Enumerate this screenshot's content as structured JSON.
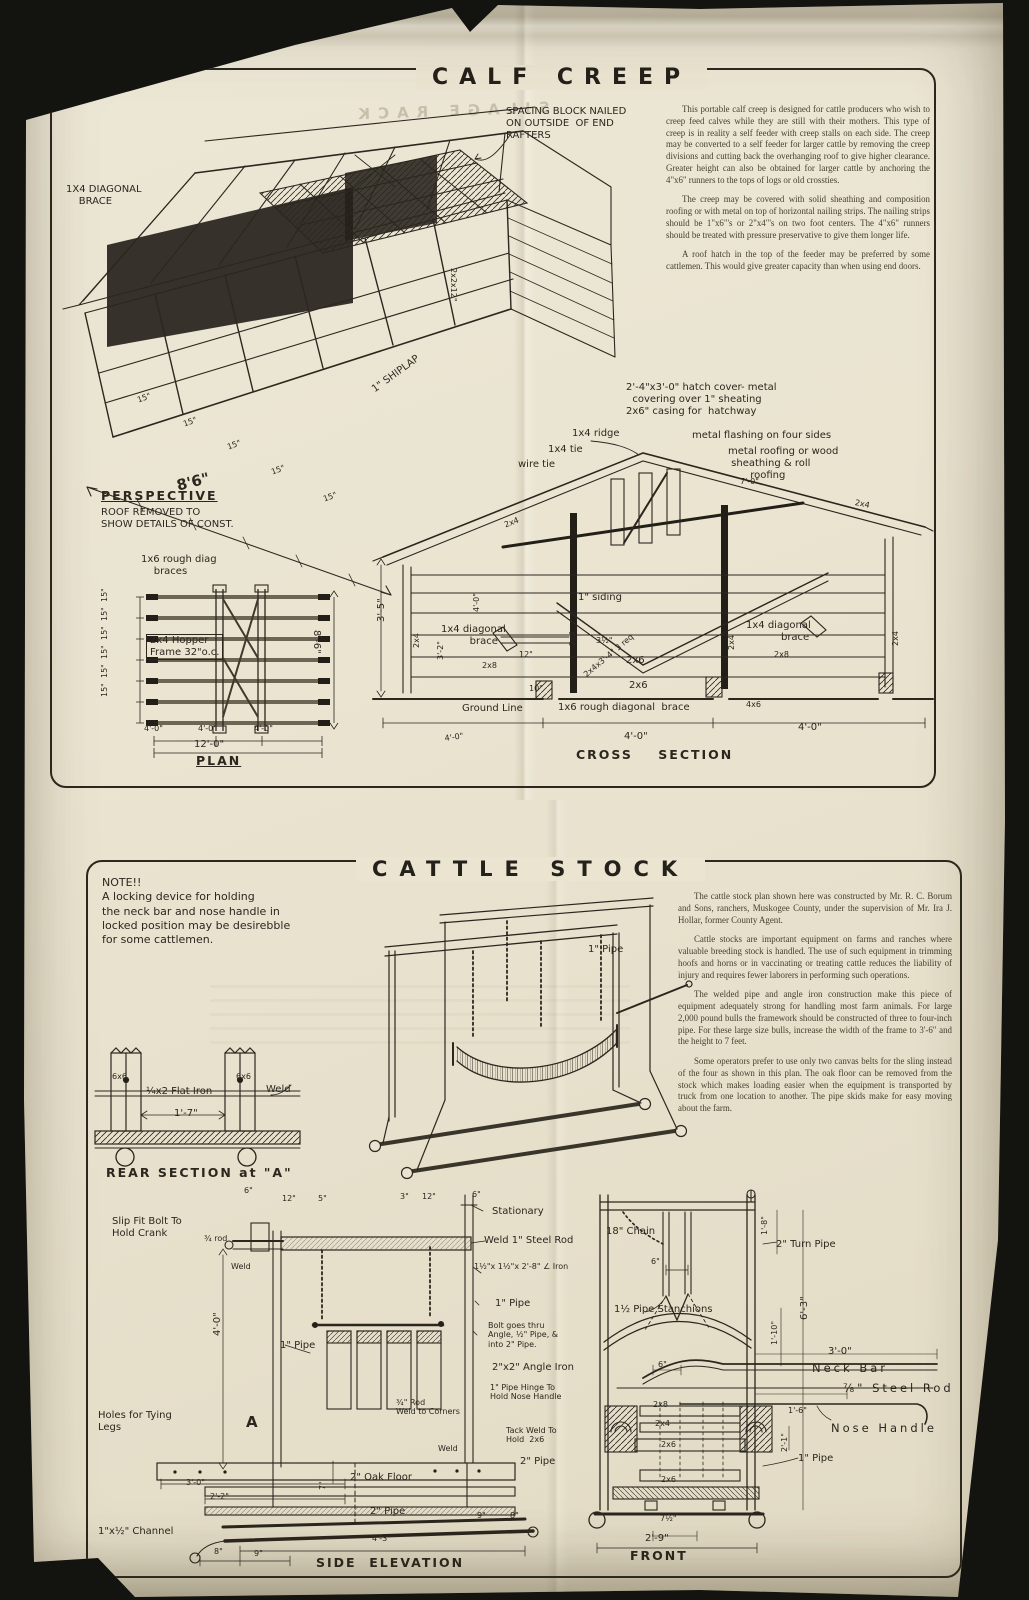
{
  "page": {
    "paper_color": "#eae4d1",
    "ink_color": "#2b271f",
    "dark_fill": "#221e18",
    "background_color": "#131310",
    "ghost_text": "SILAGE RACK"
  },
  "calf_creep": {
    "title": "CALF CREEP",
    "paragraphs": [
      "This portable calf creep is designed for cattle producers who wish to creep feed calves while they are still with their mothers. This type of creep is in reality a self feeder with creep stalls on each side. The creep may be converted to a self feeder for larger cattle by removing the creep divisions and cutting back the overhanging roof to give higher clearance. Greater height can also be obtained for larger cattle by anchoring the 4\"x6\" runners to the tops of logs or old crossties.",
      "The creep may be covered with solid sheathing and composition roofing or with metal on top of horizontal nailing strips. The nailing strips should be 1\"x6\"'s or 2\"x4\"'s on two foot centers. The 4\"x6\" runners should be treated with pressure preservative to give them longer life.",
      "A roof hatch in the top of the feeder may be preferred by some cattlemen. This would give greater capacity than when using end doors."
    ],
    "annotations": [
      {
        "n": "spacing-block-note",
        "t": "SPACING BLOCK NAILED\nON OUTSIDE  OF END\nRAFTERS",
        "x": 506,
        "y": 106
      },
      {
        "n": "diagonal-brace-label",
        "t": "1X4 DIAGONAL\n    BRACE",
        "x": 66,
        "y": 184
      },
      {
        "n": "shiplap-label",
        "t": "1\" SHIPLAP",
        "x": 370,
        "y": 386,
        "r": -36
      },
      {
        "n": "end-rafter-block-label",
        "t": "2x2x12\"",
        "x": 458,
        "y": 268,
        "r": 90,
        "c": "sm"
      },
      {
        "n": "front-spacing-tick-1",
        "t": "15\"",
        "x": 136,
        "y": 396,
        "r": -20,
        "c": "sm"
      },
      {
        "n": "front-spacing-tick-2",
        "t": "15\"",
        "x": 182,
        "y": 420,
        "r": -20,
        "c": "sm"
      },
      {
        "n": "front-spacing-tick-3",
        "t": "15\"",
        "x": 226,
        "y": 443,
        "r": -20,
        "c": "sm"
      },
      {
        "n": "front-spacing-tick-4",
        "t": "15\"",
        "x": 270,
        "y": 468,
        "r": -20,
        "c": "sm"
      },
      {
        "n": "front-spacing-tick-5",
        "t": "15\"",
        "x": 322,
        "y": 495,
        "r": -20,
        "c": "sm"
      },
      {
        "n": "overall-length-dim",
        "t": "8'6\"",
        "x": 175,
        "y": 478,
        "r": -14,
        "c": "big"
      },
      {
        "n": "perspective-caption",
        "t": "PERSPECTIVE",
        "x": 101,
        "y": 489,
        "c": "cap u"
      },
      {
        "n": "perspective-subcaption",
        "t": "ROOF REMOVED TO\nSHOW DETAILS OF CONST.",
        "x": 101,
        "y": 507
      },
      {
        "n": "plan-braces-label",
        "t": "1x6 rough diag\n    braces",
        "x": 141,
        "y": 554
      },
      {
        "n": "hopper-frame-label",
        "t": "2x4 Hopper\nFrame 32\"o.c.",
        "x": 146,
        "y": 634,
        "c": "box"
      },
      {
        "n": "plan-spacing-dim-1",
        "t": "15\"",
        "x": 100,
        "y": 602,
        "r": -90,
        "c": "sm"
      },
      {
        "n": "plan-spacing-dim-2",
        "t": "15\"",
        "x": 100,
        "y": 621,
        "r": -90,
        "c": "sm"
      },
      {
        "n": "plan-spacing-dim-3",
        "t": "15\"",
        "x": 100,
        "y": 640,
        "r": -90,
        "c": "sm"
      },
      {
        "n": "plan-spacing-dim-4",
        "t": "15\"",
        "x": 100,
        "y": 659,
        "r": -90,
        "c": "sm"
      },
      {
        "n": "plan-spacing-dim-5",
        "t": "15\"",
        "x": 100,
        "y": 678,
        "r": -90,
        "c": "sm"
      },
      {
        "n": "plan-spacing-dim-6",
        "t": "15\"",
        "x": 100,
        "y": 697,
        "r": -90,
        "c": "sm"
      },
      {
        "n": "plan-width-dim",
        "t": "8'-6\"",
        "x": 322,
        "y": 630,
        "r": 90
      },
      {
        "n": "plan-bay-dim-1",
        "t": "4'-0\"",
        "x": 144,
        "y": 724,
        "c": "sm"
      },
      {
        "n": "plan-bay-dim-2",
        "t": "4'-0\"",
        "x": 198,
        "y": 724,
        "c": "sm"
      },
      {
        "n": "plan-bay-dim-3",
        "t": "4'-0\"",
        "x": 254,
        "y": 724,
        "c": "sm"
      },
      {
        "n": "plan-total-dim",
        "t": "12'-0\"",
        "x": 194,
        "y": 739
      },
      {
        "n": "plan-caption",
        "t": "PLAN",
        "x": 196,
        "y": 754,
        "c": "cap u"
      },
      {
        "n": "hatch-cover-note",
        "t": "2'-4\"x3'-0\" hatch cover- metal\n  covering over 1\" sheating\n2x6\" casing for  hatchway",
        "x": 626,
        "y": 382
      },
      {
        "n": "ridge-label",
        "t": "1x4 ridge",
        "x": 572,
        "y": 428
      },
      {
        "n": "tie-label",
        "t": "1x4 tie",
        "x": 548,
        "y": 444
      },
      {
        "n": "wire-tie-label",
        "t": "wire tie",
        "x": 518,
        "y": 459
      },
      {
        "n": "flashing-note",
        "t": "metal flashing on four sides",
        "x": 692,
        "y": 430
      },
      {
        "n": "roofing-note",
        "t": "metal roofing or wood\n sheathing & roll\n       roofing",
        "x": 728,
        "y": 446
      },
      {
        "n": "roof-pitch-dim",
        "t": "7'-0\"",
        "x": 740,
        "y": 477,
        "c": "sm"
      },
      {
        "n": "cs-rafter-label-left",
        "t": "2x4",
        "x": 503,
        "y": 521,
        "r": -21,
        "c": "sm"
      },
      {
        "n": "cs-rafter-label-right",
        "t": "2x4",
        "x": 856,
        "y": 498,
        "r": 12,
        "c": "sm"
      },
      {
        "n": "cs-height-dim",
        "t": "3'-5\"",
        "x": 376,
        "y": 622,
        "r": -90
      },
      {
        "n": "cs-post-label-left",
        "t": "2x4",
        "x": 412,
        "y": 648,
        "r": -90,
        "c": "sm"
      },
      {
        "n": "cs-dim-4ft-vert",
        "t": "4'-0\"",
        "x": 472,
        "y": 612,
        "r": -90,
        "c": "sm"
      },
      {
        "n": "cs-dim-3-2",
        "t": "3'-2\"",
        "x": 436,
        "y": 660,
        "r": -90,
        "c": "sm"
      },
      {
        "n": "cs-diagonal-brace-left",
        "t": "1x4 diagonal\n         brace",
        "x": 441,
        "y": 624
      },
      {
        "n": "cs-dim-12",
        "t": "12\"",
        "x": 519,
        "y": 650,
        "c": "sm"
      },
      {
        "n": "cs-2x8-left",
        "t": "2x8",
        "x": 482,
        "y": 661,
        "c": "sm"
      },
      {
        "n": "cs-dim-10",
        "t": "10\"",
        "x": 529,
        "y": 684,
        "c": "sm"
      },
      {
        "n": "siding-label",
        "t": "1\" siding",
        "x": 578,
        "y": 592
      },
      {
        "n": "cs-dim-3half",
        "t": "3½\"",
        "x": 596,
        "y": 636,
        "c": "sm"
      },
      {
        "n": "hopper-board-label",
        "t": "2x4x3'-4\" 3 req",
        "x": 582,
        "y": 672,
        "r": -40,
        "c": "sm"
      },
      {
        "n": "cs-2x6-upper",
        "t": "2x6",
        "x": 626,
        "y": 655
      },
      {
        "n": "cs-2x6-lower",
        "t": "2x6",
        "x": 629,
        "y": 680
      },
      {
        "n": "cs-center-post-label",
        "t": "2x4",
        "x": 568,
        "y": 646,
        "r": -90,
        "c": "sm"
      },
      {
        "n": "cs-diagonal-brace-right",
        "t": "1x4 diagonal\n           brace",
        "x": 746,
        "y": 620
      },
      {
        "n": "cs-2x8-right",
        "t": "2x8",
        "x": 774,
        "y": 650,
        "c": "sm"
      },
      {
        "n": "cs-post-label-right",
        "t": "2x4",
        "x": 727,
        "y": 650,
        "r": -90,
        "c": "sm"
      },
      {
        "n": "cs-post-label-far-right",
        "t": "2x4",
        "x": 891,
        "y": 646,
        "r": -90,
        "c": "sm"
      },
      {
        "n": "ground-line-label",
        "t": "Ground Line",
        "x": 462,
        "y": 703
      },
      {
        "n": "cs-bottom-brace-label",
        "t": "1x6 rough diagonal  brace",
        "x": 558,
        "y": 702
      },
      {
        "n": "cs-4x6-label",
        "t": "4x6",
        "x": 746,
        "y": 700,
        "c": "sm"
      },
      {
        "n": "cs-dim-left",
        "t": "4'-0\"",
        "x": 444,
        "y": 734,
        "r": -8,
        "c": "sm"
      },
      {
        "n": "cs-dim-mid",
        "t": "4'-0\"",
        "x": 624,
        "y": 731
      },
      {
        "n": "cs-dim-right",
        "t": "4'-0\"",
        "x": 798,
        "y": 722
      },
      {
        "n": "cross-section-caption",
        "t": "CROSS    SECTION",
        "x": 576,
        "y": 748,
        "c": "cap"
      }
    ]
  },
  "cattle_stock": {
    "title": "CATTLE STOCK",
    "note": "NOTE!!\n A locking device for holding\nthe neck bar and nose handle in\nlocked position may be desirebble\nfor some cattlemen.",
    "paragraphs": [
      "The cattle stock plan shown here was constructed by Mr. R. C. Borum and Sons, ranchers, Muskogee County, under the supervision of Mr. Ira J. Hollar, former County Agent.",
      "Cattle stocks are important equipment on farms and ranches where valuable breeding stock is handled. The use of such equipment in trimming hoofs and horns or in vaccinating or treating cattle reduces the liability of injury and requires fewer laborers in performing such operations.",
      "The welded pipe and angle iron construction make this piece of equipment adequately strong for handling most farm animals. For large 2,000 pound bulls the framework should be constructed of three to four-inch pipe. For these large size bulls, increase the width of the frame to 3'-6\" and the height to 7 feet.",
      "Some operators prefer to use only two canvas belts for the sling instead of the four as shown in this plan. The oak floor can be removed from the stock which makes loading easier when the equipment is transported by truck from one location to another. The pipe skids make for easy moving about the farm."
    ],
    "annotations": [
      {
        "n": "pipe-label-perspective",
        "t": "1\" Pipe",
        "x": 588,
        "y": 944
      },
      {
        "n": "rear-post-label-left",
        "t": "6x6",
        "x": 112,
        "y": 1072,
        "c": "sm"
      },
      {
        "n": "rear-post-label-right",
        "t": "6x6",
        "x": 236,
        "y": 1072,
        "c": "sm"
      },
      {
        "n": "flat-iron-label",
        "t": "¼x2 Flat Iron",
        "x": 146,
        "y": 1086
      },
      {
        "n": "rear-weld-label",
        "t": "Weld",
        "x": 266,
        "y": 1084
      },
      {
        "n": "rear-width-dim",
        "t": "1'-7\"",
        "x": 174,
        "y": 1108
      },
      {
        "n": "rear-section-caption",
        "t": "REAR SECTION at \"A\"",
        "x": 106,
        "y": 1166,
        "c": "cap"
      },
      {
        "n": "crank-note",
        "t": "Slip Fit Bolt To\nHold Crank",
        "x": 112,
        "y": 1216
      },
      {
        "n": "rod-label",
        "t": "¾ rod",
        "x": 204,
        "y": 1234,
        "c": "sm"
      },
      {
        "n": "se-weld-label",
        "t": "Weld",
        "x": 231,
        "y": 1262,
        "c": "sm"
      },
      {
        "n": "se-dim-6",
        "t": "6\"",
        "x": 244,
        "y": 1186,
        "c": "sm"
      },
      {
        "n": "se-dim-12",
        "t": "12\"",
        "x": 282,
        "y": 1194,
        "c": "sm"
      },
      {
        "n": "se-dim-5",
        "t": "5\"",
        "x": 318,
        "y": 1194,
        "c": "sm"
      },
      {
        "n": "se-dim-3",
        "t": "3\"",
        "x": 400,
        "y": 1192,
        "c": "sm"
      },
      {
        "n": "se-dim-12b",
        "t": "12\"",
        "x": 422,
        "y": 1192,
        "c": "sm"
      },
      {
        "n": "se-dim-6b",
        "t": "6\"",
        "x": 472,
        "y": 1190,
        "c": "sm"
      },
      {
        "n": "stationary-label",
        "t": "Stationary",
        "x": 492,
        "y": 1206
      },
      {
        "n": "steel-rod-weld-note",
        "t": "Weld 1\" Steel Rod",
        "x": 484,
        "y": 1235
      },
      {
        "n": "angle-iron-size-note",
        "t": "1½\"x 1½\"x 2'-8\" ∠ Iron",
        "x": 474,
        "y": 1262,
        "c": "sm"
      },
      {
        "n": "se-pipe-label",
        "t": "1\" Pipe",
        "x": 495,
        "y": 1298
      },
      {
        "n": "bolt-note",
        "t": "Bolt goes thru\nAngle, ½\" Pipe, &\ninto 2\" Pipe.",
        "x": 488,
        "y": 1321,
        "c": "sm"
      },
      {
        "n": "angle-iron-label",
        "t": "2\"x2\" Angle Iron",
        "x": 492,
        "y": 1362
      },
      {
        "n": "pipe-hinge-note",
        "t": "1\" Pipe Hinge To\nHold Nose Handle",
        "x": 490,
        "y": 1383,
        "c": "sm"
      },
      {
        "n": "tack-weld-note",
        "t": "Tack Weld To\nHold  2x6",
        "x": 506,
        "y": 1426,
        "c": "sm"
      },
      {
        "n": "se-2in-pipe-label",
        "t": "2\" Pipe",
        "x": 520,
        "y": 1456
      },
      {
        "n": "se-weld2-label",
        "t": "Weld",
        "x": 438,
        "y": 1444,
        "c": "sm"
      },
      {
        "n": "rod-corners-note",
        "t": "¾\" Rod\nWeld to Corners",
        "x": 396,
        "y": 1398,
        "c": "sm"
      },
      {
        "n": "se-sling-pipe-label",
        "t": "1\" Pipe",
        "x": 280,
        "y": 1340
      },
      {
        "n": "se-height-dim",
        "t": "4'-0\"",
        "x": 212,
        "y": 1336,
        "r": -90
      },
      {
        "n": "tying-holes-note",
        "t": "Holes for Tying\nLegs",
        "x": 98,
        "y": 1410
      },
      {
        "n": "section-a-marker",
        "t": "A",
        "x": 246,
        "y": 1414,
        "c": "big"
      },
      {
        "n": "se-dim-3ft",
        "t": "3'-0\"",
        "x": 186,
        "y": 1478,
        "c": "sm"
      },
      {
        "n": "se-dim-2-2",
        "t": "2'-2\"",
        "x": 210,
        "y": 1492,
        "c": "sm"
      },
      {
        "n": "channel-label",
        "t": "1\"x½\" Channel",
        "x": 98,
        "y": 1526
      },
      {
        "n": "se-dim-8",
        "t": "8\"",
        "x": 214,
        "y": 1547,
        "c": "sm"
      },
      {
        "n": "se-dim-9",
        "t": "9\"",
        "x": 254,
        "y": 1549,
        "c": "sm"
      },
      {
        "n": "oak-floor-label",
        "t": "2\" Oak Floor",
        "x": 350,
        "y": 1472
      },
      {
        "n": "se-bottom-pipe-label",
        "t": "2\" Pipe",
        "x": 370,
        "y": 1506
      },
      {
        "n": "se-dim-4-3",
        "t": "4'-3\"",
        "x": 372,
        "y": 1534,
        "c": "sm"
      },
      {
        "n": "se-dim-7",
        "t": "7\"",
        "x": 318,
        "y": 1490,
        "r": -90,
        "c": "sm"
      },
      {
        "n": "side-elevation-caption",
        "t": "SIDE  ELEVATION",
        "x": 316,
        "y": 1556,
        "c": "cap"
      },
      {
        "n": "mid-dim-9",
        "t": "9\"",
        "x": 477,
        "y": 1511,
        "c": "sm"
      },
      {
        "n": "mid-dim-8",
        "t": "8\"",
        "x": 510,
        "y": 1511,
        "c": "sm"
      },
      {
        "n": "chain-label",
        "t": "18\" Chain",
        "x": 606,
        "y": 1226
      },
      {
        "n": "fr-dim-6",
        "t": "6\"",
        "x": 651,
        "y": 1257,
        "c": "sm"
      },
      {
        "n": "turn-pipe-label",
        "t": "2\" Turn Pipe",
        "x": 776,
        "y": 1239
      },
      {
        "n": "fr-dim-1-8",
        "t": "1'-8\"",
        "x": 760,
        "y": 1235,
        "r": -90,
        "c": "sm"
      },
      {
        "n": "fr-dim-6-3",
        "t": "6'-3\"",
        "x": 799,
        "y": 1320,
        "r": -90
      },
      {
        "n": "fr-dim-1-10",
        "t": "1'-10\"",
        "x": 770,
        "y": 1345,
        "r": -90,
        "c": "sm"
      },
      {
        "n": "stanchion-label",
        "t": "1½ Pipe Stanchions",
        "x": 614,
        "y": 1304
      },
      {
        "n": "fr-dim-6b",
        "t": "6\"",
        "x": 658,
        "y": 1360,
        "c": "sm"
      },
      {
        "n": "fr-2x8-label",
        "t": "2x8",
        "x": 653,
        "y": 1400,
        "c": "sm"
      },
      {
        "n": "fr-2x4-label",
        "t": "2x4",
        "x": 655,
        "y": 1419,
        "c": "sm"
      },
      {
        "n": "fr-2x6-label",
        "t": "2x6",
        "x": 661,
        "y": 1440,
        "c": "sm"
      },
      {
        "n": "fr-2x6b-label",
        "t": "2x6",
        "x": 661,
        "y": 1475,
        "c": "sm"
      },
      {
        "n": "fr-dim-7half",
        "t": "7½\"",
        "x": 660,
        "y": 1514,
        "c": "sm"
      },
      {
        "n": "fr-dim-2-9",
        "t": "2'-9\"",
        "x": 645,
        "y": 1533
      },
      {
        "n": "front-caption",
        "t": "FRONT",
        "x": 630,
        "y": 1549,
        "c": "cap"
      },
      {
        "n": "neck-bar-dim",
        "t": "3'-0\"",
        "x": 828,
        "y": 1346
      },
      {
        "n": "neck-bar-label",
        "t": "Neck Bar",
        "x": 812,
        "y": 1362,
        "c": "sp"
      },
      {
        "n": "steel-rod-label",
        "t": "⅞\" Steel Rod",
        "x": 843,
        "y": 1382,
        "c": "sp"
      },
      {
        "n": "fr-dim-1-6",
        "t": "1'-6\"",
        "x": 788,
        "y": 1406,
        "c": "sm"
      },
      {
        "n": "nose-handle-label",
        "t": "Nose Handle",
        "x": 831,
        "y": 1422,
        "c": "sp"
      },
      {
        "n": "fr-pipe-label",
        "t": "1\" Pipe",
        "x": 798,
        "y": 1453
      },
      {
        "n": "fr-dim-2-1",
        "t": "2'-1\"",
        "x": 780,
        "y": 1452,
        "r": -90,
        "c": "sm"
      }
    ]
  }
}
